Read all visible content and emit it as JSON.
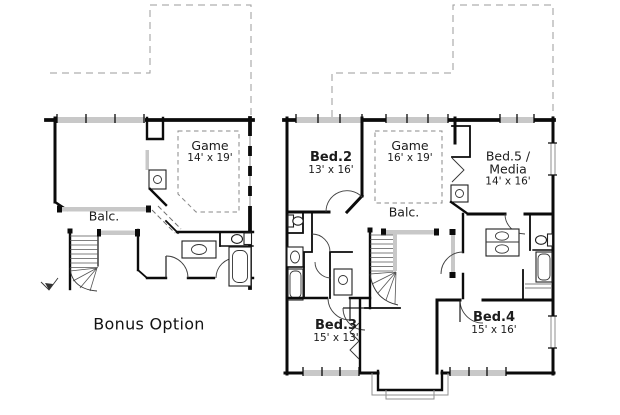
{
  "title": "Second floor plan with bonus option",
  "colors": {
    "background": "#ffffff",
    "wall": "#0b0b0b",
    "window_fill": "#c8c8c8",
    "roofline_dash": "#9b9b9b",
    "room_boundary_dash": "#8a8a8a",
    "text": "#1c1c1c"
  },
  "plans": {
    "left": {
      "caption": "Bonus Option",
      "labels": {
        "game": {
          "name": "Game",
          "dims": "14' x 19'"
        },
        "balcony": {
          "name": "Balc."
        }
      }
    },
    "right": {
      "labels": {
        "bed2": {
          "name": "Bed.2",
          "dims": "13' x 16'"
        },
        "game": {
          "name": "Game",
          "dims": "16' x 19'"
        },
        "bed5": {
          "name": "Bed.5 /",
          "name2": "Media",
          "dims": "14' x 16'"
        },
        "balcony": {
          "name": "Balc."
        },
        "bed3": {
          "name": "Bed.3",
          "dims": "15' x 13'"
        },
        "bed4": {
          "name": "Bed.4",
          "dims": "15' x 16'"
        }
      }
    }
  }
}
